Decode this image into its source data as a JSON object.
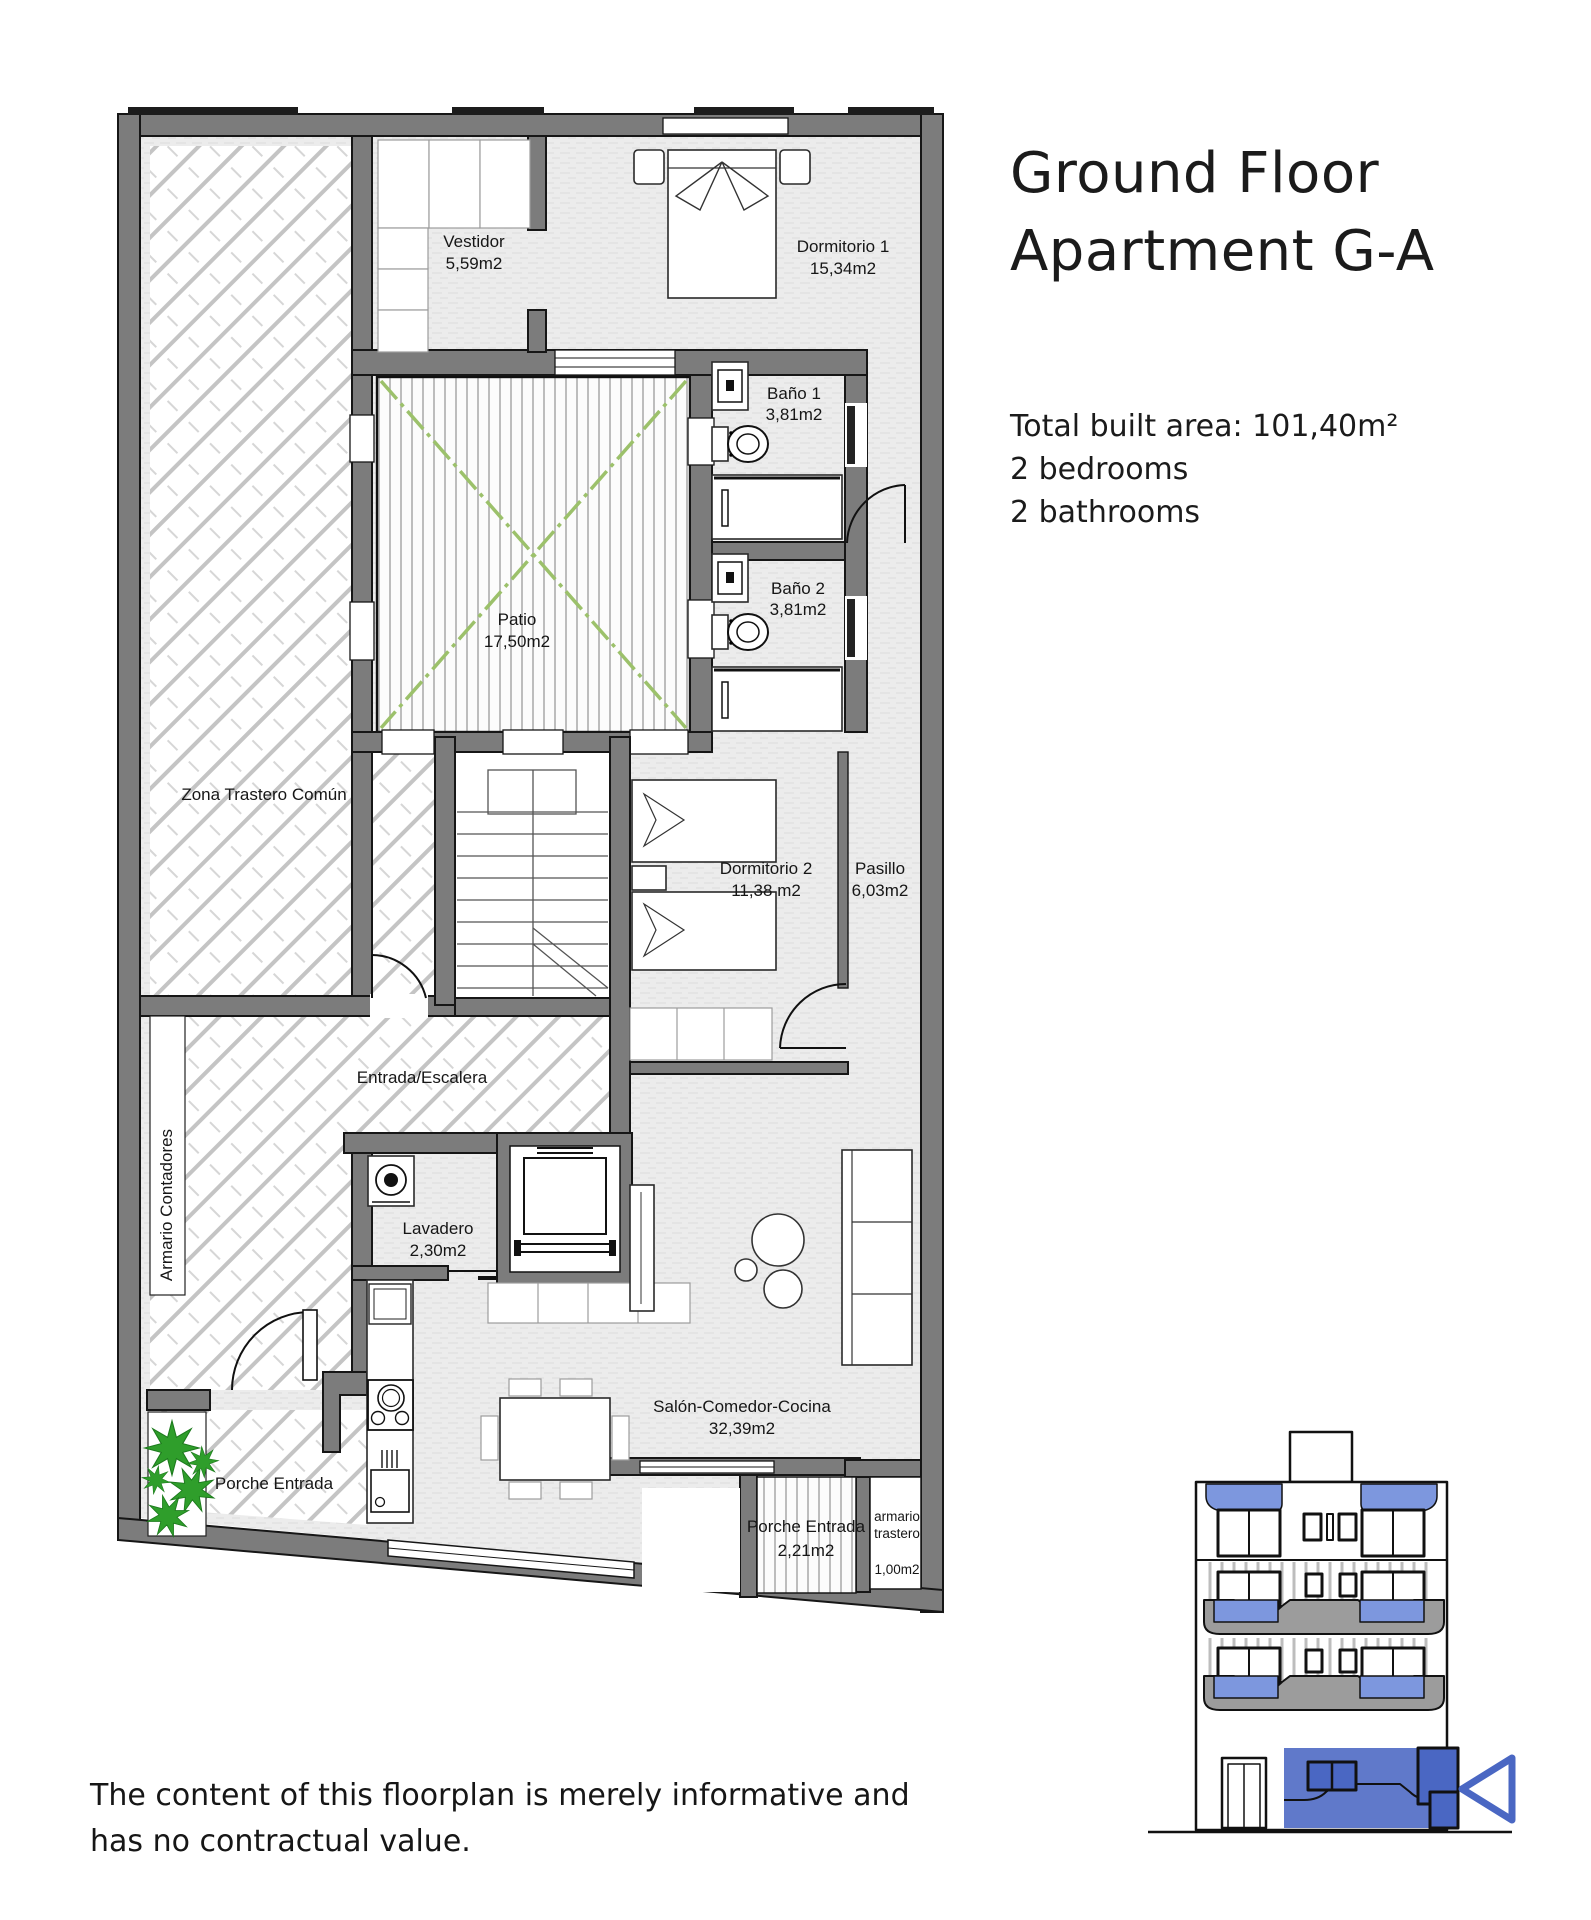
{
  "title": {
    "line1": "Ground Floor",
    "line2": "Apartment G-A"
  },
  "details": {
    "total_area": "Total built area: 101,40m²",
    "bedrooms": "2 bedrooms",
    "bathrooms": "2 bathrooms"
  },
  "disclaimer": {
    "line1": "The content of this floorplan is merely informative and",
    "line2": "has no contractual value."
  },
  "rooms": {
    "vestidor": {
      "name": "Vestidor",
      "area": "5,59m2"
    },
    "dormitorio1": {
      "name": "Dormitorio 1",
      "area": "15,34m2"
    },
    "bano1": {
      "name": "Baño 1",
      "area": "3,81m2"
    },
    "bano2": {
      "name": "Baño 2",
      "area": "3,81m2"
    },
    "patio": {
      "name": "Patio",
      "area": "17,50m2"
    },
    "zona_trastero": {
      "name": "Zona Trastero Común"
    },
    "dormitorio2": {
      "name": "Dormitorio 2",
      "area": "11,38 m2"
    },
    "pasillo": {
      "name": "Pasillo",
      "area": "6,03m2"
    },
    "entrada_escalera": {
      "name": "Entrada/Escalera"
    },
    "armario_contadores": {
      "name": "Armario Contadores"
    },
    "lavadero": {
      "name": "Lavadero",
      "area": "2,30m2"
    },
    "porche_entrada_sw": {
      "name": "Porche Entrada"
    },
    "salon": {
      "name": "Salón-Comedor-Cocina",
      "area": "32,39m2"
    },
    "porche_entrada_se": {
      "name": "Porche Entrada",
      "area": "2,21m2"
    },
    "armario_trastero": {
      "name_line1": "armario",
      "name_line2": "trastero",
      "area": "1,00m2"
    }
  },
  "colors": {
    "wall_gray": "#7c7c7c",
    "floor_gray": "#ececec",
    "hatch_gray": "#c4c4c4",
    "patio_green": "#9cc16b",
    "plant_green": "#2f9e2b",
    "elevation_glass_blue": "#7d97de",
    "elevation_highlight_blue": "#4a67c3"
  }
}
